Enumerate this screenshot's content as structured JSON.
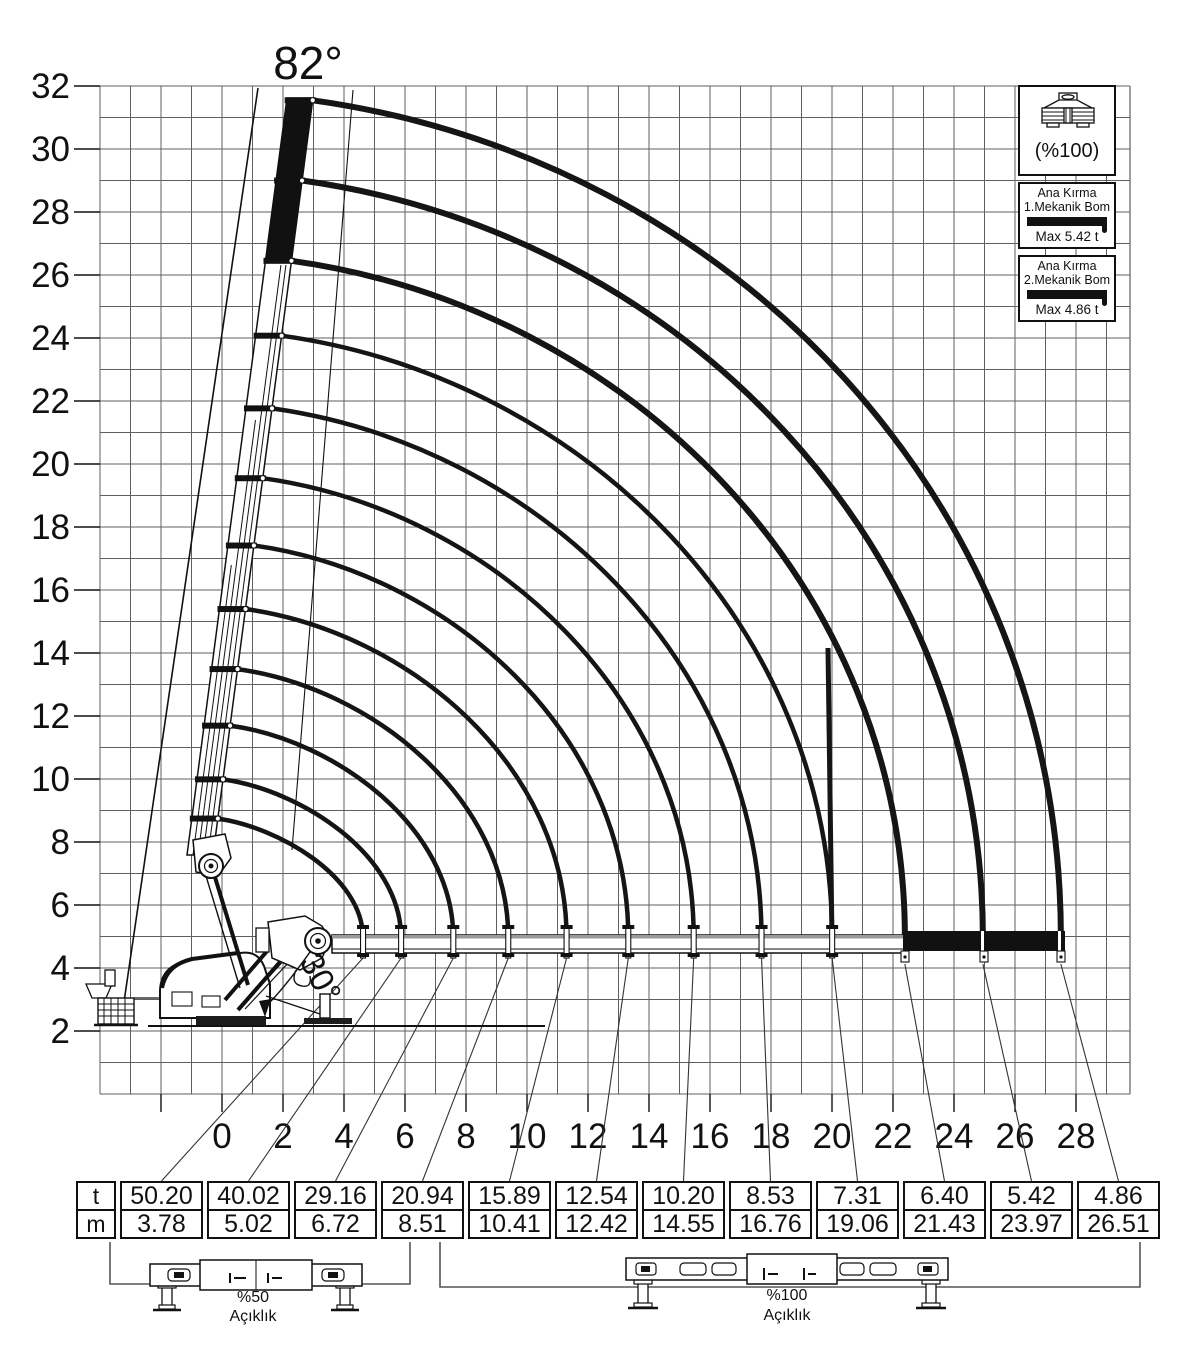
{
  "page": {
    "title_angle_label": "82°",
    "knuckle_angle_label": "30°"
  },
  "legend": {
    "outrigger_label": "(%100)",
    "items": [
      {
        "line1": "Ana Kırma",
        "line2": "1.Mekanik Bom",
        "max_label": "Max 5.42 t"
      },
      {
        "line1": "Ana Kırma",
        "line2": "2.Mekanik Bom",
        "max_label": "Max 4.86 t"
      }
    ]
  },
  "load_table": {
    "unit_numerator": "t",
    "unit_denominator": "m",
    "columns": [
      {
        "t": "50.20",
        "m": "3.78"
      },
      {
        "t": "40.02",
        "m": "5.02"
      },
      {
        "t": "29.16",
        "m": "6.72"
      },
      {
        "t": "20.94",
        "m": "8.51"
      },
      {
        "t": "15.89",
        "m": "10.41"
      },
      {
        "t": "12.54",
        "m": "12.42"
      },
      {
        "t": "10.20",
        "m": "14.55"
      },
      {
        "t": "8.53",
        "m": "16.76"
      },
      {
        "t": "7.31",
        "m": "19.06"
      },
      {
        "t": "6.40",
        "m": "21.43"
      },
      {
        "t": "5.42",
        "m": "23.97"
      },
      {
        "t": "4.86",
        "m": "26.51"
      }
    ]
  },
  "outrigger_diagrams": [
    {
      "percent": "%50",
      "label": "Açıklık"
    },
    {
      "percent": "%100",
      "label": "Açıklık"
    }
  ],
  "chart_data": {
    "type": "line",
    "title": "Crane lifting capacity envelope (boom luffing 82° to 0°)",
    "x_axis": {
      "label": "reach (m)",
      "ticks": [
        0,
        2,
        4,
        6,
        8,
        10,
        12,
        14,
        16,
        18,
        20,
        22,
        24,
        26,
        28
      ],
      "range": [
        -4,
        29.8
      ],
      "grid": true
    },
    "y_axis": {
      "label": "height (m)",
      "ticks": [
        32,
        30,
        28,
        26,
        24,
        22,
        20,
        18,
        16,
        14,
        12,
        10,
        8,
        6,
        4,
        2
      ],
      "range": [
        0,
        32
      ],
      "grid": true
    },
    "grid_step_m": 1,
    "boom_angle_max_deg": 82,
    "knuckle_angle_deg": 30,
    "boom_pivot": {
      "x_m": 0.8,
      "y_m": 4.95
    },
    "curves": [
      {
        "reach_m": 3.78,
        "capacity_t": 50.2
      },
      {
        "reach_m": 5.02,
        "capacity_t": 40.02
      },
      {
        "reach_m": 6.72,
        "capacity_t": 29.16
      },
      {
        "reach_m": 8.51,
        "capacity_t": 20.94
      },
      {
        "reach_m": 10.41,
        "capacity_t": 15.89
      },
      {
        "reach_m": 12.42,
        "capacity_t": 12.54
      },
      {
        "reach_m": 14.55,
        "capacity_t": 10.2
      },
      {
        "reach_m": 16.76,
        "capacity_t": 8.53
      },
      {
        "reach_m": 19.06,
        "capacity_t": 7.31
      },
      {
        "reach_m": 21.43,
        "capacity_t": 6.4
      },
      {
        "reach_m": 23.97,
        "capacity_t": 5.42
      },
      {
        "reach_m": 26.51,
        "capacity_t": 4.86
      }
    ],
    "mechanical_section_boundary_reach_m": 19.06,
    "mechanical_boom_max_capacities_t": [
      5.42,
      4.86
    ],
    "legend_position": "top-right"
  }
}
